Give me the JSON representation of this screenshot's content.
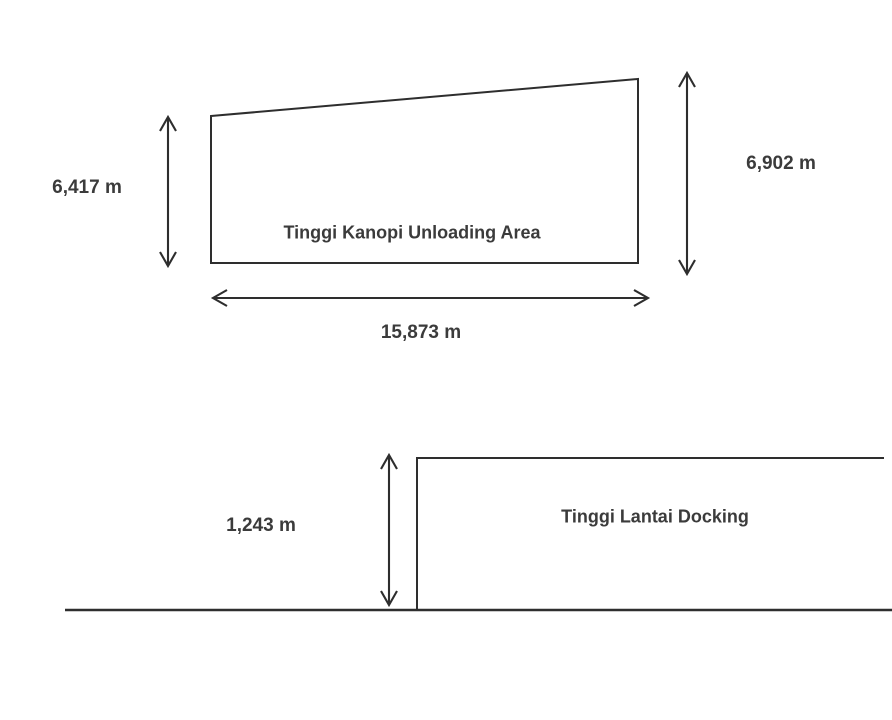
{
  "canopy_figure": {
    "label": "Tinggi Kanopi Unloading Area",
    "left_height": "6,417 m",
    "right_height": "6,902 m",
    "width": "15,873 m"
  },
  "docking_figure": {
    "label": "Tinggi Lantai Docking",
    "step_height": "1,243 m"
  },
  "icons": {
    "arrows": "double-headed-dimension-arrow"
  },
  "colors": {
    "line": "#2e2e2e",
    "text": "#3b3b3b",
    "background": "#ffffff"
  }
}
